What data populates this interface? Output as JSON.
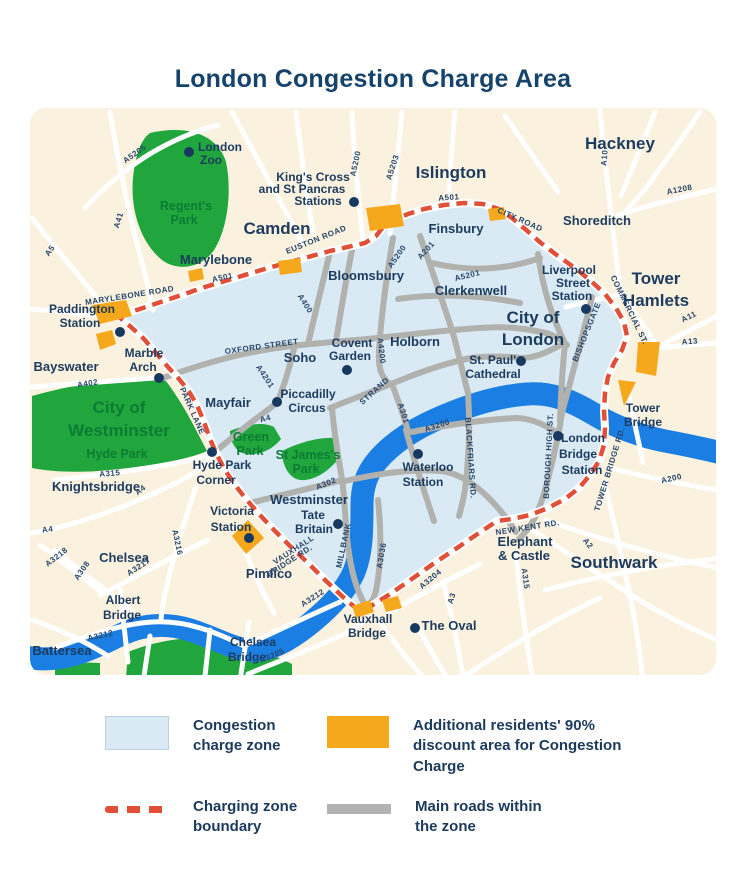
{
  "title": "London Congestion Charge Area",
  "colors": {
    "page_background": "#ffffff",
    "map_background": "#faf1df",
    "congestion_zone": "#d9eaf5",
    "river": "#1b7ee3",
    "park": "#21a63d",
    "discount_area": "#f6a81c",
    "boundary": "#e14f38",
    "main_road_gray": "#b1b1ae",
    "label_navy": "#1c3b5e",
    "park_label_green": "#0c7c35"
  },
  "legend": {
    "items": [
      {
        "key": "zone",
        "label": "Congestion charge zone"
      },
      {
        "key": "discount",
        "label": "Additional residents' 90% discount area for Congestion Charge"
      },
      {
        "key": "boundary",
        "label": "Charging zone boundary"
      },
      {
        "key": "roads",
        "label": "Main roads within the zone"
      }
    ]
  },
  "map": {
    "labels": [
      {
        "t": "Hackney",
        "x": 620,
        "y": 149,
        "c": "xl"
      },
      {
        "t": "Islington",
        "x": 451,
        "y": 178,
        "c": "xl"
      },
      {
        "t": "Camden",
        "x": 277,
        "y": 234,
        "c": "xl"
      },
      {
        "t": "Tower",
        "x": 656,
        "y": 284,
        "c": "xl"
      },
      {
        "t": "Hamlets",
        "x": 656,
        "y": 306,
        "c": "xl"
      },
      {
        "t": "City of",
        "x": 533,
        "y": 323,
        "c": "xl"
      },
      {
        "t": "London",
        "x": 533,
        "y": 345,
        "c": "xl"
      },
      {
        "t": "Southwark",
        "x": 614,
        "y": 568,
        "c": "xl"
      },
      {
        "t": "City of",
        "x": 119,
        "y": 413,
        "c": "xlg"
      },
      {
        "t": "Westminster",
        "x": 119,
        "y": 436,
        "c": "xlg"
      },
      {
        "t": "Hyde Park",
        "x": 117,
        "y": 458,
        "c": "park"
      },
      {
        "t": "Shoreditch",
        "x": 597,
        "y": 225,
        "c": "md"
      },
      {
        "t": "Finsbury",
        "x": 456,
        "y": 233,
        "c": "md"
      },
      {
        "t": "Marylebone",
        "x": 216,
        "y": 264,
        "c": "md"
      },
      {
        "t": "Bayswater",
        "x": 66,
        "y": 371,
        "c": "md"
      },
      {
        "t": "Knightsbridge",
        "x": 96,
        "y": 491,
        "c": "md"
      },
      {
        "t": "Chelsea",
        "x": 124,
        "y": 562,
        "c": "md"
      },
      {
        "t": "Pimlico",
        "x": 269,
        "y": 578,
        "c": "md"
      },
      {
        "t": "Battersea",
        "x": 62,
        "y": 655,
        "c": "md"
      },
      {
        "t": "Bloomsbury",
        "x": 366,
        "y": 280,
        "c": "md"
      },
      {
        "t": "Clerkenwell",
        "x": 471,
        "y": 295,
        "c": "md"
      },
      {
        "t": "Holborn",
        "x": 415,
        "y": 346,
        "c": "md"
      },
      {
        "t": "Soho",
        "x": 300,
        "y": 362,
        "c": "md"
      },
      {
        "t": "Mayfair",
        "x": 228,
        "y": 407,
        "c": "md"
      },
      {
        "t": "Westminster",
        "x": 309,
        "y": 504,
        "c": "md"
      },
      {
        "t": "The Oval",
        "x": 449,
        "y": 630,
        "c": "md"
      },
      {
        "t": "Elephant",
        "x": 525,
        "y": 546,
        "c": "md"
      },
      {
        "t": "& Castle",
        "x": 524,
        "y": 560,
        "c": "md"
      },
      {
        "t": "London",
        "x": 220,
        "y": 151,
        "c": "poi"
      },
      {
        "t": "Zoo",
        "x": 211,
        "y": 164,
        "c": "poi"
      },
      {
        "t": "King's Cross",
        "x": 313,
        "y": 181,
        "c": "poi"
      },
      {
        "t": "and St Pancras",
        "x": 302,
        "y": 193,
        "c": "poi"
      },
      {
        "t": "Stations",
        "x": 318,
        "y": 205,
        "c": "poi"
      },
      {
        "t": "Paddington",
        "x": 82,
        "y": 313,
        "c": "poi"
      },
      {
        "t": "Station",
        "x": 80,
        "y": 327,
        "c": "poi"
      },
      {
        "t": "Marble",
        "x": 144,
        "y": 357,
        "c": "poi"
      },
      {
        "t": "Arch",
        "x": 143,
        "y": 371,
        "c": "poi"
      },
      {
        "t": "Piccadilly",
        "x": 308,
        "y": 398,
        "c": "poi"
      },
      {
        "t": "Circus",
        "x": 307,
        "y": 412,
        "c": "poi"
      },
      {
        "t": "Covent",
        "x": 352,
        "y": 347,
        "c": "poi"
      },
      {
        "t": "Garden",
        "x": 350,
        "y": 360,
        "c": "poi"
      },
      {
        "t": "St. Paul's",
        "x": 496,
        "y": 364,
        "c": "poi"
      },
      {
        "t": "Cathedral",
        "x": 493,
        "y": 378,
        "c": "poi"
      },
      {
        "t": "Liverpool",
        "x": 569,
        "y": 274,
        "c": "poi"
      },
      {
        "t": "Street",
        "x": 573,
        "y": 287,
        "c": "poi"
      },
      {
        "t": "Station",
        "x": 572,
        "y": 300,
        "c": "poi"
      },
      {
        "t": "London",
        "x": 583,
        "y": 442,
        "c": "poi"
      },
      {
        "t": "Bridge",
        "x": 578,
        "y": 458,
        "c": "poi"
      },
      {
        "t": "Station",
        "x": 582,
        "y": 474,
        "c": "poi"
      },
      {
        "t": "Waterloo",
        "x": 428,
        "y": 471,
        "c": "poi"
      },
      {
        "t": "Station",
        "x": 423,
        "y": 486,
        "c": "poi"
      },
      {
        "t": "Tate",
        "x": 313,
        "y": 519,
        "c": "poi"
      },
      {
        "t": "Britain",
        "x": 314,
        "y": 533,
        "c": "poi"
      },
      {
        "t": "Victoria",
        "x": 232,
        "y": 515,
        "c": "poi"
      },
      {
        "t": "Station",
        "x": 231,
        "y": 531,
        "c": "poi"
      },
      {
        "t": "Hyde Park",
        "x": 222,
        "y": 469,
        "c": "poi"
      },
      {
        "t": "Corner",
        "x": 216,
        "y": 484,
        "c": "poi"
      },
      {
        "t": "Vauxhall",
        "x": 368,
        "y": 623,
        "c": "poi"
      },
      {
        "t": "Bridge",
        "x": 367,
        "y": 637,
        "c": "poi"
      },
      {
        "t": "Chelsea",
        "x": 253,
        "y": 646,
        "c": "poi"
      },
      {
        "t": "Bridge",
        "x": 247,
        "y": 661,
        "c": "poi"
      },
      {
        "t": "Albert",
        "x": 123,
        "y": 604,
        "c": "poi"
      },
      {
        "t": "Bridge",
        "x": 122,
        "y": 619,
        "c": "poi"
      },
      {
        "t": "Tower",
        "x": 643,
        "y": 412,
        "c": "poi"
      },
      {
        "t": "Bridge",
        "x": 643,
        "y": 426,
        "c": "poi"
      },
      {
        "t": "Regent's",
        "x": 186,
        "y": 210,
        "c": "park"
      },
      {
        "t": "Park",
        "x": 184,
        "y": 224,
        "c": "park"
      },
      {
        "t": "Green",
        "x": 251,
        "y": 441,
        "c": "park"
      },
      {
        "t": "Park",
        "x": 250,
        "y": 455,
        "c": "park"
      },
      {
        "t": "St James's",
        "x": 308,
        "y": 459,
        "c": "park"
      },
      {
        "t": "Park",
        "x": 306,
        "y": 473,
        "c": "park"
      },
      {
        "t": "MARYLEBONE ROAD",
        "x": 130,
        "y": 298,
        "c": "road",
        "r": -9
      },
      {
        "t": "A501",
        "x": 223,
        "y": 280,
        "c": "road",
        "r": -12
      },
      {
        "t": "EUSTON ROAD",
        "x": 317,
        "y": 242,
        "c": "road",
        "r": -22
      },
      {
        "t": "A501",
        "x": 449,
        "y": 200,
        "c": "road",
        "r": -4
      },
      {
        "t": "CITY ROAD",
        "x": 519,
        "y": 222,
        "c": "road",
        "r": 24
      },
      {
        "t": "A5200",
        "x": 358,
        "y": 164,
        "c": "road",
        "r": -78
      },
      {
        "t": "A5203",
        "x": 395,
        "y": 168,
        "c": "road",
        "r": -72
      },
      {
        "t": "A5205",
        "x": 136,
        "y": 156,
        "c": "road",
        "r": -35
      },
      {
        "t": "A41",
        "x": 121,
        "y": 221,
        "c": "road",
        "r": -73
      },
      {
        "t": "A5",
        "x": 52,
        "y": 252,
        "c": "road",
        "r": -55
      },
      {
        "t": "A400",
        "x": 303,
        "y": 305,
        "c": "road",
        "r": 58
      },
      {
        "t": "A4200",
        "x": 379,
        "y": 351,
        "c": "road",
        "r": 84
      },
      {
        "t": "A5200",
        "x": 399,
        "y": 258,
        "c": "road",
        "r": -55
      },
      {
        "t": "A201",
        "x": 428,
        "y": 252,
        "c": "road",
        "r": -48
      },
      {
        "t": "A5201",
        "x": 468,
        "y": 278,
        "c": "road",
        "r": -14
      },
      {
        "t": "OXFORD STREET",
        "x": 262,
        "y": 349,
        "c": "road",
        "r": -8
      },
      {
        "t": "A4201",
        "x": 263,
        "y": 378,
        "c": "road",
        "r": 56
      },
      {
        "t": "A4",
        "x": 266,
        "y": 421,
        "c": "road",
        "r": -15
      },
      {
        "t": "STRAND",
        "x": 376,
        "y": 393,
        "c": "road",
        "r": -42
      },
      {
        "t": "A301",
        "x": 401,
        "y": 414,
        "c": "road",
        "r": 72
      },
      {
        "t": "A3200",
        "x": 438,
        "y": 428,
        "c": "road",
        "r": -18
      },
      {
        "t": "BLACKFRIARS RD.",
        "x": 468,
        "y": 458,
        "c": "road",
        "r": 86
      },
      {
        "t": "BISHOPSGATE",
        "x": 589,
        "y": 333,
        "c": "road",
        "r": -68
      },
      {
        "t": "COMMERCIAL ST.",
        "x": 627,
        "y": 311,
        "c": "road",
        "r": 64
      },
      {
        "t": "A10",
        "x": 607,
        "y": 158,
        "c": "road",
        "r": -85
      },
      {
        "t": "A1208",
        "x": 680,
        "y": 192,
        "c": "road",
        "r": -11
      },
      {
        "t": "A11",
        "x": 690,
        "y": 319,
        "c": "road",
        "r": -26
      },
      {
        "t": "A13",
        "x": 690,
        "y": 344,
        "c": "road",
        "r": -4
      },
      {
        "t": "A200",
        "x": 672,
        "y": 481,
        "c": "road",
        "r": -13
      },
      {
        "t": "TOWER BRIDGE RD.",
        "x": 612,
        "y": 470,
        "c": "road",
        "r": -73
      },
      {
        "t": "BOROUGH HIGH ST.",
        "x": 551,
        "y": 456,
        "c": "road",
        "r": -87
      },
      {
        "t": "NEW KENT RD.",
        "x": 528,
        "y": 530,
        "c": "road",
        "r": -9
      },
      {
        "t": "A2",
        "x": 586,
        "y": 545,
        "c": "road",
        "r": 52
      },
      {
        "t": "A315",
        "x": 523,
        "y": 579,
        "c": "road",
        "r": 82
      },
      {
        "t": "A315",
        "x": 110,
        "y": 476,
        "c": "road",
        "r": -5
      },
      {
        "t": "A4",
        "x": 142,
        "y": 492,
        "c": "road",
        "r": -38
      },
      {
        "t": "A4",
        "x": 48,
        "y": 532,
        "c": "road",
        "r": -8
      },
      {
        "t": "A402",
        "x": 88,
        "y": 386,
        "c": "road",
        "r": -9
      },
      {
        "t": "PARK LANE",
        "x": 190,
        "y": 412,
        "c": "road",
        "r": 66
      },
      {
        "t": "MILLBANK",
        "x": 346,
        "y": 546,
        "c": "road",
        "r": -78
      },
      {
        "t": "A3036",
        "x": 384,
        "y": 556,
        "c": "road",
        "r": -80
      },
      {
        "t": "VAUXHALL",
        "x": 295,
        "y": 552,
        "c": "road",
        "r": -33
      },
      {
        "t": "BRIDGE RD.",
        "x": 291,
        "y": 563,
        "c": "road",
        "r": -33
      },
      {
        "t": "A302",
        "x": 327,
        "y": 486,
        "c": "road",
        "r": -22
      },
      {
        "t": "A3212",
        "x": 101,
        "y": 638,
        "c": "road",
        "r": -13
      },
      {
        "t": "A3212",
        "x": 314,
        "y": 600,
        "c": "road",
        "r": -33
      },
      {
        "t": "A3205",
        "x": 273,
        "y": 658,
        "c": "road",
        "r": -23
      },
      {
        "t": "A3204",
        "x": 432,
        "y": 581,
        "c": "road",
        "r": -40
      },
      {
        "t": "A3",
        "x": 454,
        "y": 599,
        "c": "road",
        "r": -72
      },
      {
        "t": "A3216",
        "x": 175,
        "y": 543,
        "c": "road",
        "r": 78
      },
      {
        "t": "A3217",
        "x": 140,
        "y": 569,
        "c": "road",
        "r": -33
      },
      {
        "t": "A308",
        "x": 84,
        "y": 572,
        "c": "road",
        "r": -55
      },
      {
        "t": "A3218",
        "x": 58,
        "y": 559,
        "c": "road",
        "r": -38
      }
    ],
    "dots": [
      {
        "name": "london-zoo",
        "x": 189,
        "y": 152
      },
      {
        "name": "kings-cross-st-pancras",
        "x": 354,
        "y": 202
      },
      {
        "name": "paddington-station",
        "x": 120,
        "y": 332
      },
      {
        "name": "marble-arch",
        "x": 159,
        "y": 378
      },
      {
        "name": "piccadilly-circus",
        "x": 277,
        "y": 402
      },
      {
        "name": "covent-garden",
        "x": 347,
        "y": 370
      },
      {
        "name": "st-pauls-cathedral",
        "x": 521,
        "y": 361
      },
      {
        "name": "liverpool-street-station",
        "x": 586,
        "y": 309
      },
      {
        "name": "london-bridge-station",
        "x": 558,
        "y": 436
      },
      {
        "name": "hyde-park-corner",
        "x": 212,
        "y": 452
      },
      {
        "name": "victoria-station",
        "x": 249,
        "y": 538
      },
      {
        "name": "tate-britain",
        "x": 338,
        "y": 524
      },
      {
        "name": "waterloo-station",
        "x": 418,
        "y": 454
      },
      {
        "name": "the-oval",
        "x": 415,
        "y": 628
      }
    ]
  }
}
